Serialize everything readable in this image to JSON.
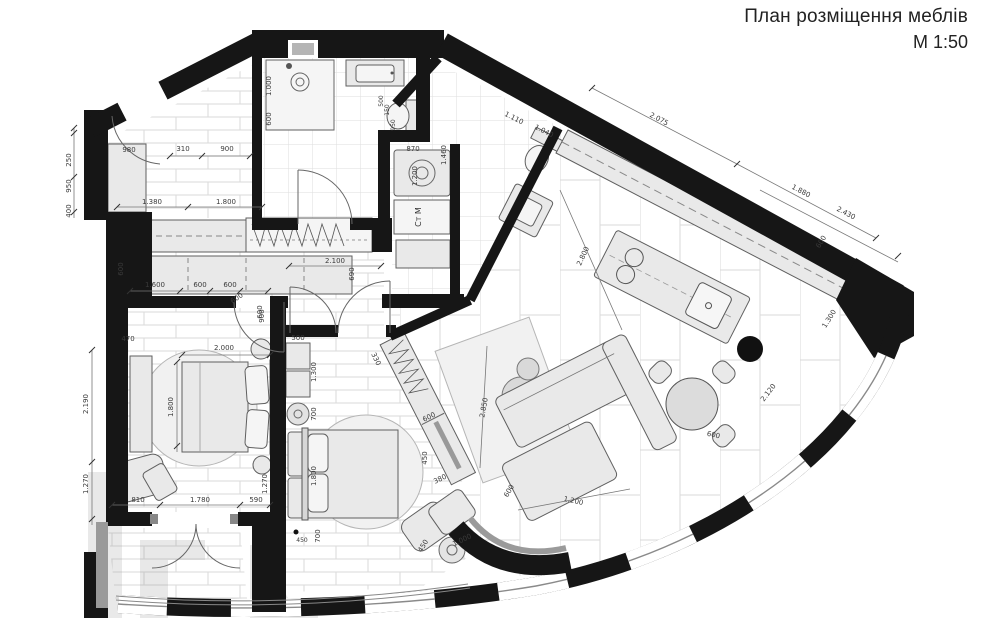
{
  "title": {
    "line1": "План розміщення меблів",
    "line2": "М 1:50"
  },
  "labels": {
    "washing_machine": "Ст М",
    "fridge": "970"
  },
  "dims": {
    "hall": {
      "cabinet": "980",
      "d310": "310",
      "d900": "900",
      "w1380": "1.380",
      "w1800": "1.800",
      "row1600": "1.600",
      "row600a": "600",
      "row600b": "600",
      "row600c": "600",
      "row600d": "600",
      "v600": "600",
      "v690": "690",
      "corridor": "2.100"
    },
    "left": {
      "d250": "250",
      "d950": "950",
      "d400": "400",
      "d2190": "2.190",
      "d1270": "1.270"
    },
    "bedroom1": {
      "d470": "470",
      "bed_w": "2.000",
      "bed_l": "1.800",
      "d810": "810",
      "d1780": "1.780",
      "d590": "590",
      "r1270": "1.270",
      "r900": "900"
    },
    "bathroom": {
      "shower_w": "1.000",
      "shower_d": "600",
      "wc500": "500",
      "wc150": "150",
      "wc950": "950"
    },
    "laundry": {
      "d870": "870",
      "d1200": "1.200",
      "d1460": "1.460"
    },
    "wc": {
      "d1110": "1.110",
      "d1040": "1.040"
    },
    "kitchen": {
      "d2075": "2.075",
      "d1880": "1.880",
      "d2430": "2.430",
      "d2800": "2.800"
    },
    "living": {
      "rug": "2.850",
      "d1200": "1.200",
      "d600": "600",
      "table": "600"
    },
    "window": {
      "d600": "600",
      "d1300": "1.300",
      "d2120": "2.120"
    },
    "bedroom2": {
      "c500": "500",
      "c1300": "1.300",
      "d700a": "700",
      "bed": "1.800",
      "d700b": "700",
      "w600": "600",
      "w450": "450",
      "w380": "380",
      "w330": "330",
      "chair1000": "1.000",
      "chair450": "450",
      "socket450": "450"
    }
  }
}
